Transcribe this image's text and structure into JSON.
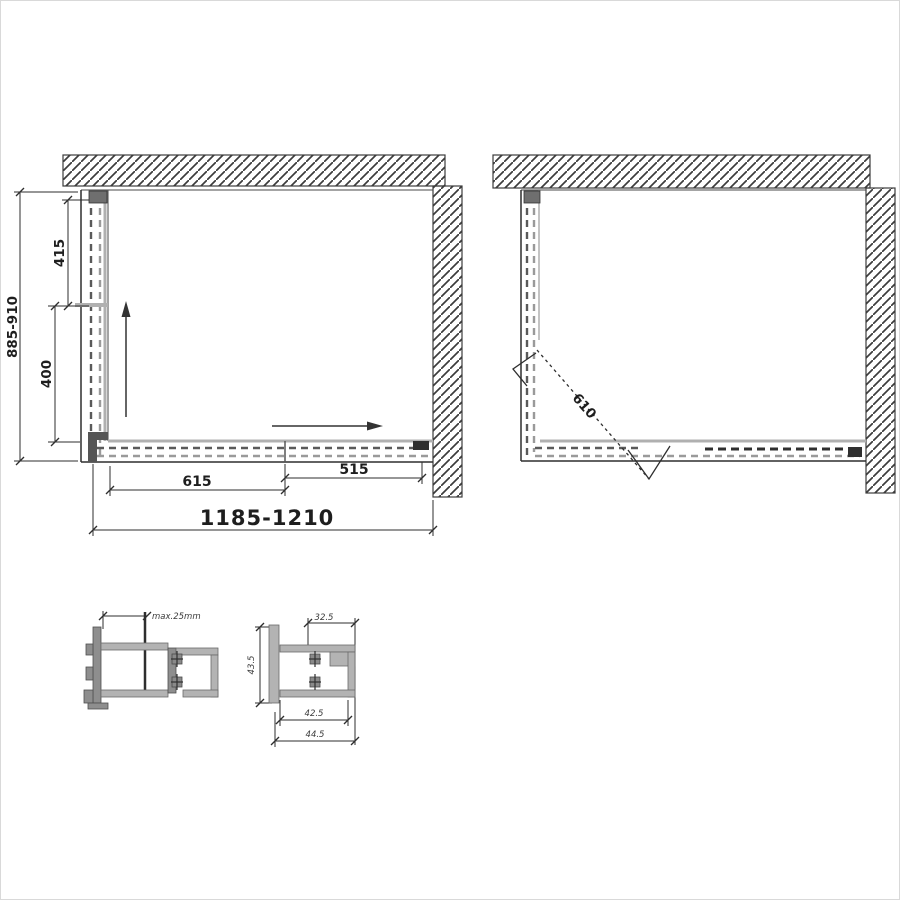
{
  "colors": {
    "ink": "#2e2e2e",
    "glass_dash": "#8c8c8c",
    "profile_gray": "#b3b3b3",
    "background": "#ffffff"
  },
  "plan_closed": {
    "depth_overall": "885-910",
    "depth_upper": "415",
    "depth_lower": "400",
    "width_fixed": "615",
    "width_door": "515",
    "width_overall": "1185-1210"
  },
  "plan_open": {
    "door_width": "610"
  },
  "detail_left": {
    "adjustment": "max.25mm"
  },
  "detail_right": {
    "top_width": "32.5",
    "side_height": "43.5",
    "inner_width": "42.5",
    "outer_width": "44.5"
  }
}
